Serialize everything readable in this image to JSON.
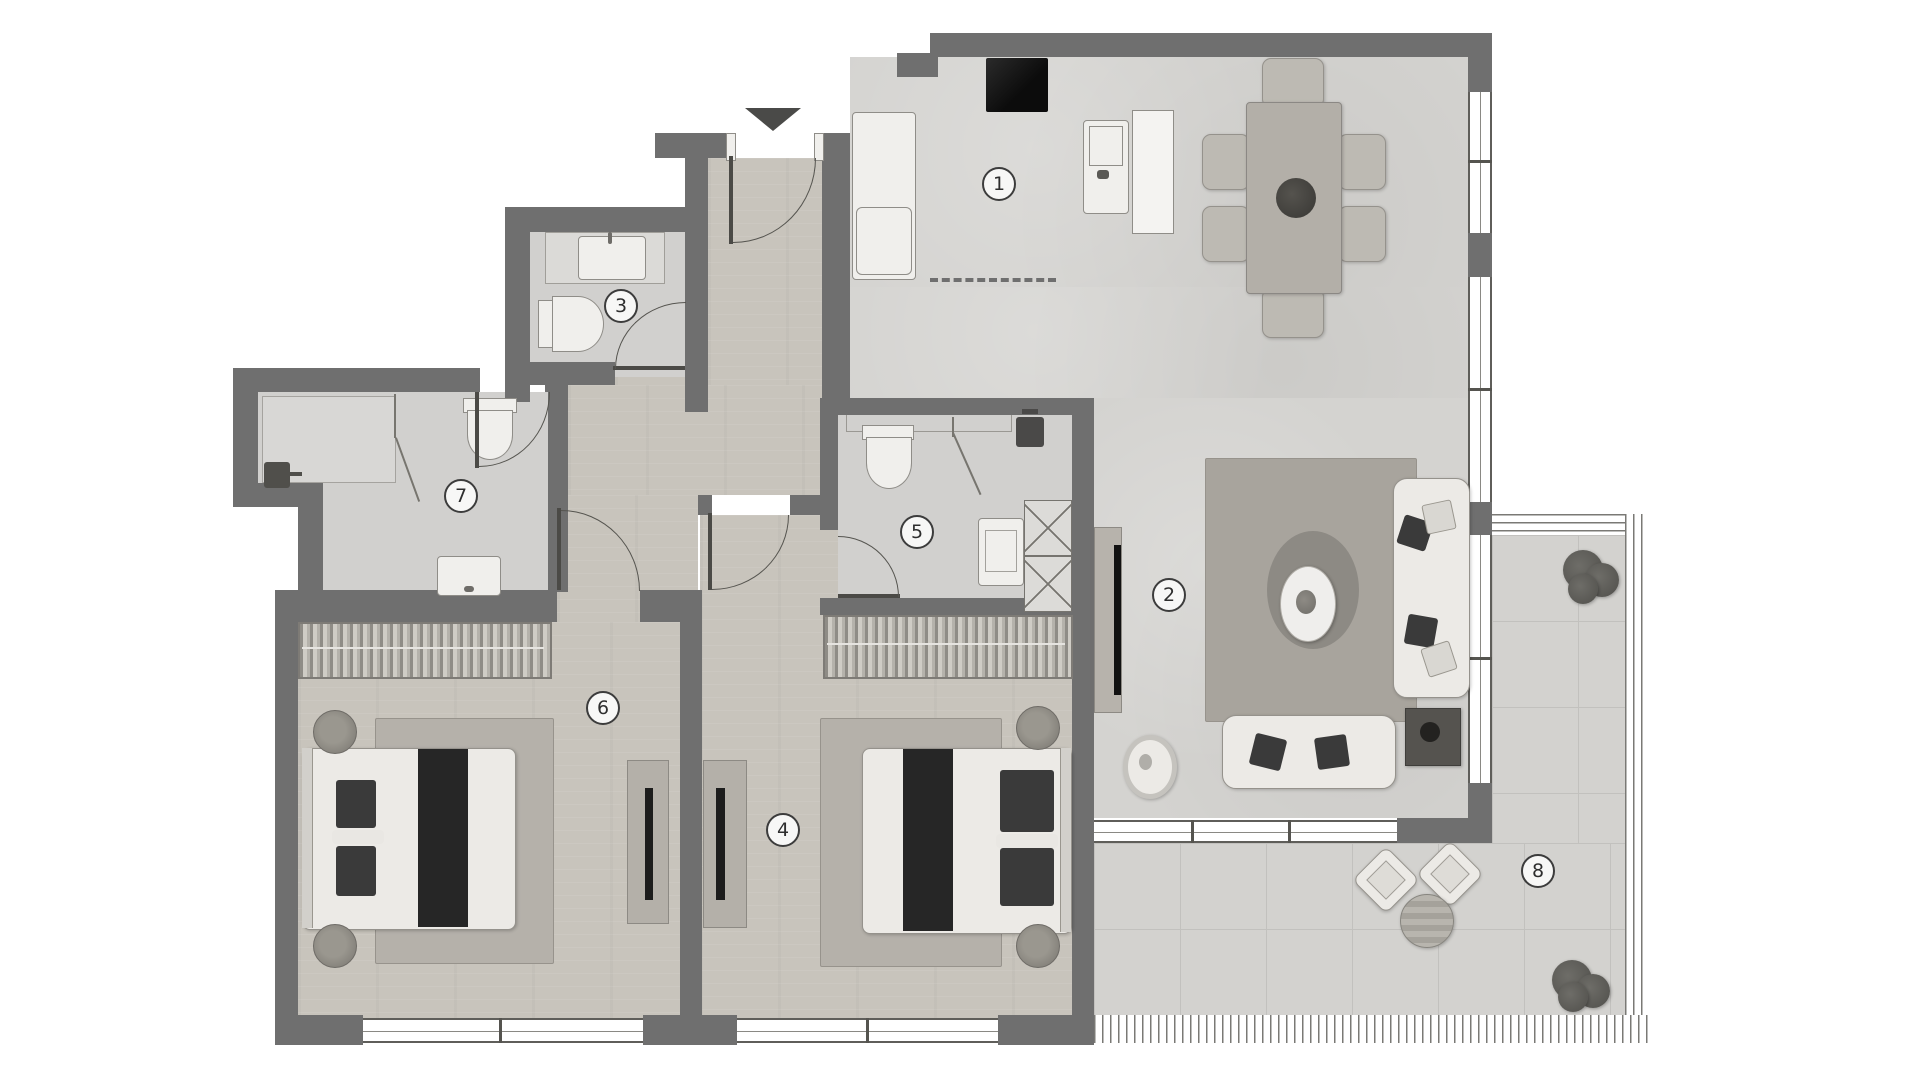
{
  "plan": {
    "type": "apartment floor plan (top view render)",
    "entry_marker": "▼"
  },
  "rooms": [
    {
      "label": "1"
    },
    {
      "label": "2"
    },
    {
      "label": "3"
    },
    {
      "label": "4"
    },
    {
      "label": "5"
    },
    {
      "label": "6"
    },
    {
      "label": "7"
    },
    {
      "label": "8"
    }
  ],
  "colors": {
    "wall": "#6f6f6f",
    "floor_wood": "#c8c4bc",
    "floor_tile": "#d4d3d0",
    "floor_bath": "#d1d0ce",
    "terrace": "#d3d2cf",
    "stove": "#151515",
    "dark_furniture": "#3a3a3a"
  }
}
